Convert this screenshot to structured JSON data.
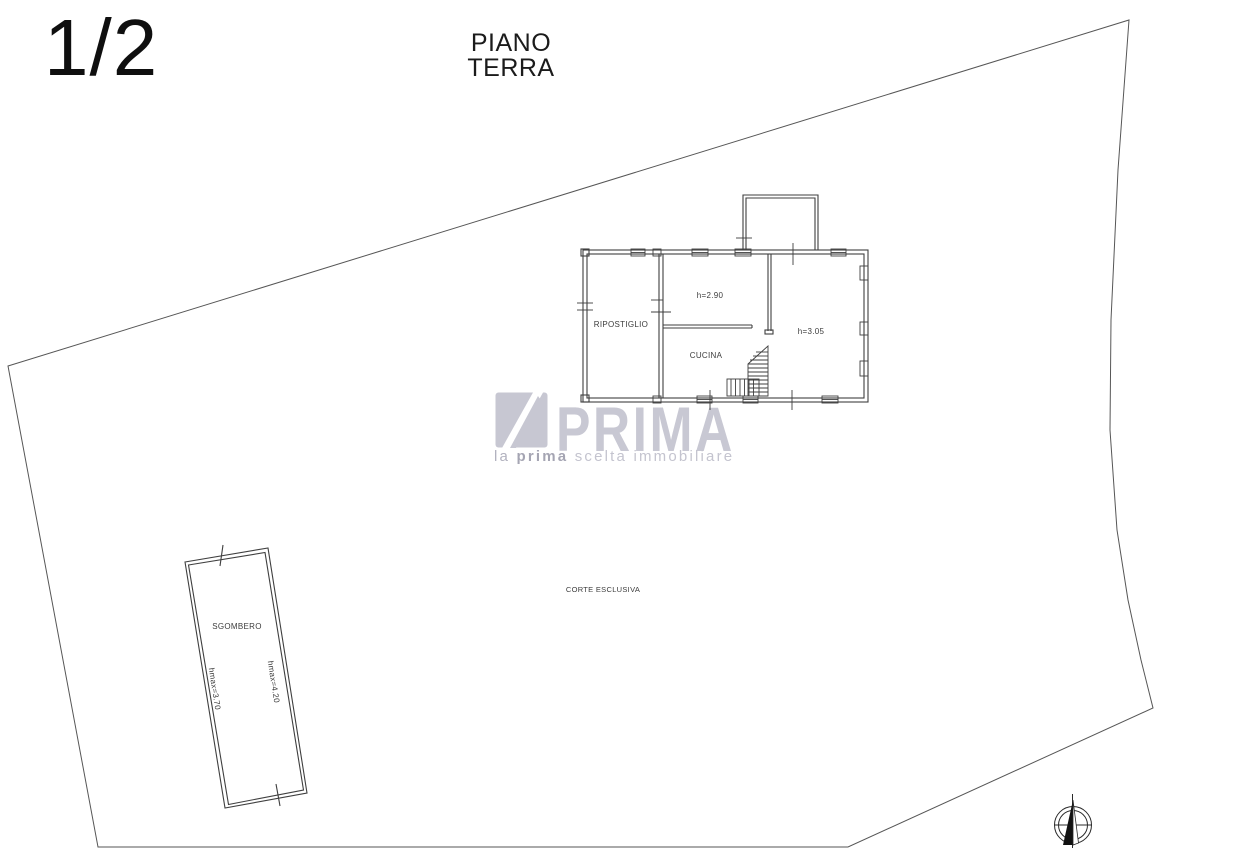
{
  "page": {
    "sheet_number": "1/2",
    "title": "PIANO TERRA"
  },
  "plan": {
    "rooms": {
      "ripostiglio": "RIPOSTIGLIO",
      "cucina": "CUCINA",
      "cucina_height": "h=2.90",
      "right_room_height": "h=3.05"
    },
    "outdoor": {
      "corte": "CORTE ESCLUSIVA"
    },
    "annex": {
      "name": "SGOMBERO",
      "hmax_right": "hmax=4.20",
      "hmax_left": "hmax=3.70"
    }
  },
  "watermark": {
    "brand": "PRIMA",
    "tagline_la": "la",
    "tagline_prima": "prima",
    "tagline_rest": "scelta immobiliare"
  },
  "icons": {
    "compass": "north-compass"
  },
  "colors": {
    "line": "#4f4f4f",
    "building_line": "#3f3f3f",
    "text": "#3c3c3c",
    "watermark_gray": "#c7c7d2"
  }
}
